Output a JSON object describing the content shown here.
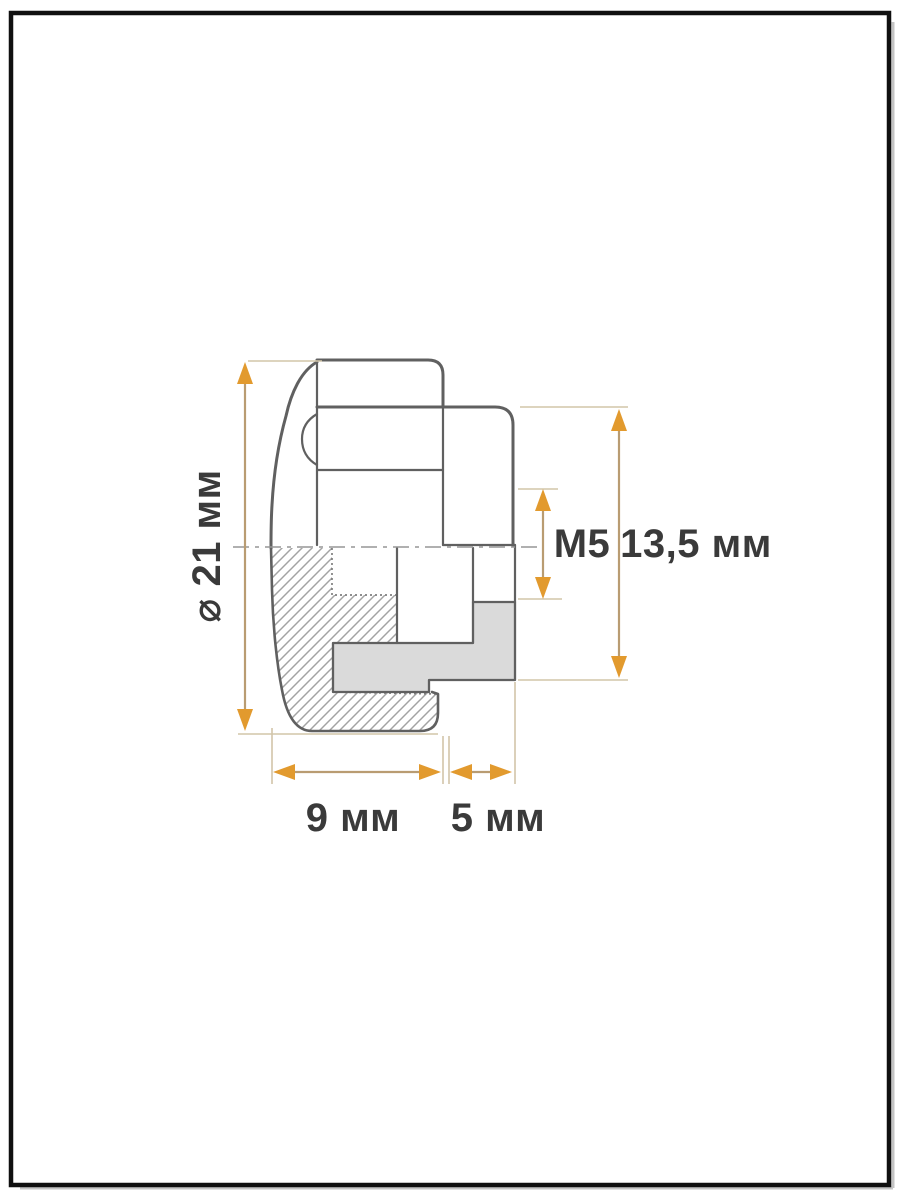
{
  "drawing": {
    "title": "knob-cross-section-technical-drawing",
    "dimensions": {
      "diameter_label": "⌀ 21 мм",
      "thread_label": "M5",
      "height_label": "13,5 мм",
      "body_width_label": "9 мм",
      "boss_width_label": "5 мм"
    },
    "colors": {
      "outline": "#606060",
      "dim_line": "#b99c72",
      "ext_line": "#d2c5a9",
      "arrow": "#e29a2e",
      "text": "#3a3a3a",
      "insert_fill": "#dadada",
      "hatch": "#a3a3a3",
      "frame": "#101010"
    }
  }
}
